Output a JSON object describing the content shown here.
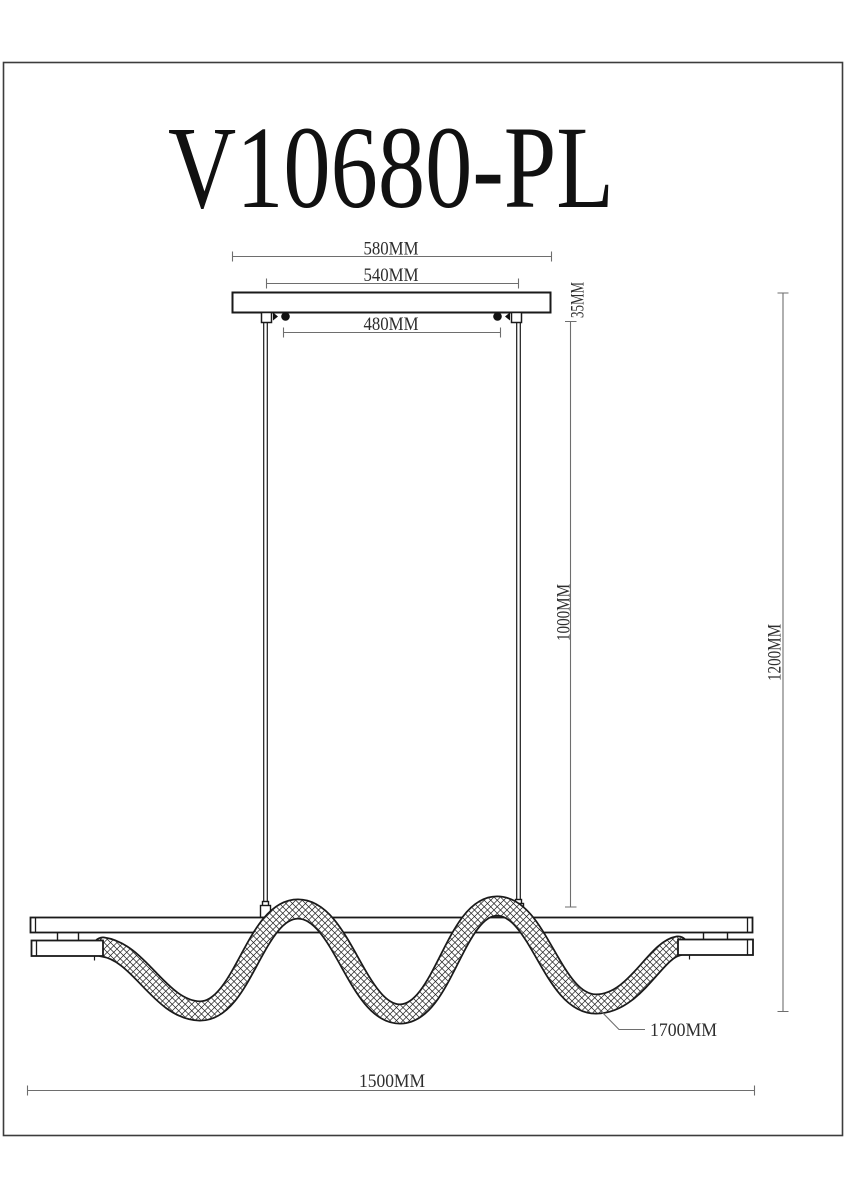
{
  "page": {
    "title": "V10680-PL",
    "background": "#ffffff"
  },
  "drawing": {
    "kind": "pendant-light-fixture-technical-drawing",
    "colors": {
      "outline": "#1a1a1a",
      "dimension_line": "#6e6e6e",
      "dimension_text": "#2e2e2e",
      "frame": "#3c3c3c"
    },
    "dimensions": {
      "canopy_width": "580MM",
      "canopy_inner_width": "540MM",
      "suspension_spacing": "480MM",
      "canopy_height": "35MM",
      "cable_drop": "1000MM",
      "overall_height": "1200MM",
      "flex_tube_length": "1700MM",
      "bar_length": "1500MM"
    }
  }
}
